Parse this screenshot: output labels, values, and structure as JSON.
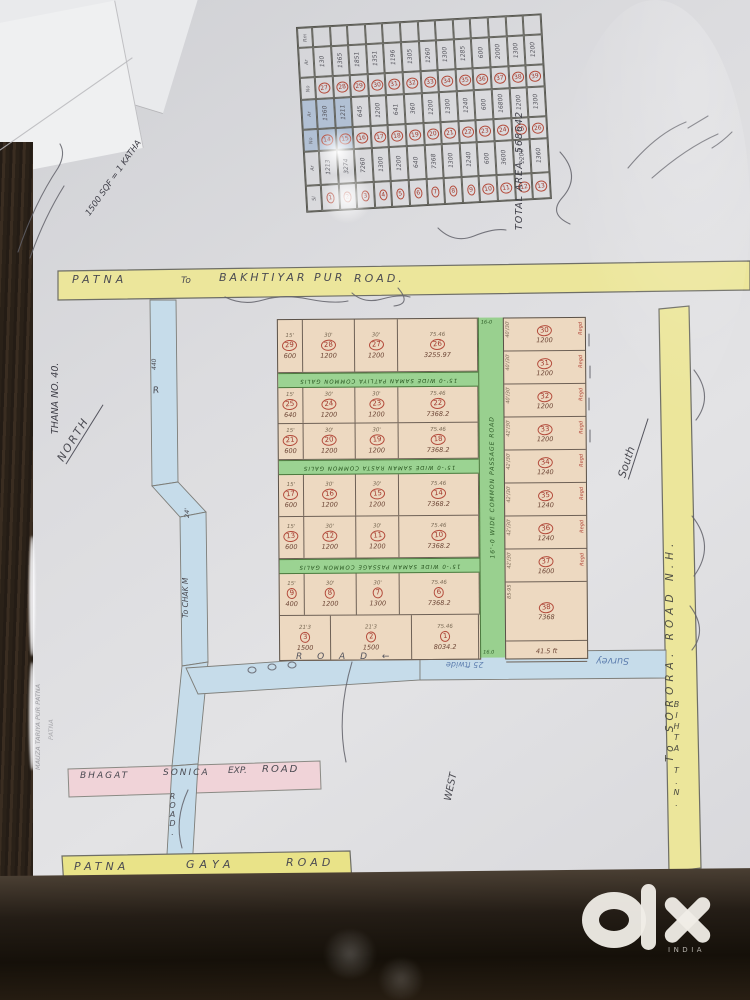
{
  "photo": {
    "watermark": {
      "brand": "olx",
      "region": "INDIA"
    }
  },
  "roads": {
    "top": {
      "words": [
        "PATNA",
        "To",
        "BAKHTIYAR PUR",
        "ROAD."
      ]
    },
    "right": {
      "label_full": "To SORORA. ROAD  N.H.",
      "bottom": "BIHTA T.N."
    },
    "bottom": {
      "words": [
        "PATNA",
        "GAYA",
        "ROAD"
      ]
    },
    "pink": {
      "words": [
        "BHAGAT",
        "SONICA",
        "EXP.",
        "ROAD"
      ]
    },
    "left": {
      "top": "440",
      "r": "R",
      "mid": "To CHAK M",
      "width": "24'",
      "bottom": "ROAD."
    },
    "main": {
      "label": "R O A D ←",
      "width_note": "25 ftwide",
      "survey": "Survey"
    },
    "green_vertical": {
      "label": "16'-0 WIDE COMMON PASSAGE ROAD",
      "top_mark": "16-0",
      "bottom_mark": "16.0"
    },
    "green_strips": [
      "15'-0 WIDE SAMAN PATLIYA COMMON GALIS",
      "15'-0 WIDE SAMAN RASTA COMMON GALIS",
      "15'-0 WIDE SAMAN PASSAGE COMMON GALIS"
    ]
  },
  "compass": {
    "north": "NORTH",
    "south": "South",
    "west": "WEST"
  },
  "notes": {
    "thana": "THANA NO. 40.",
    "katha": "1500 SQF = 1 KATHA",
    "total_area": "TOTAL AREA. 568642",
    "margin1": "MAUZA TARIYA PUR PATNA",
    "margin2": "PATNA"
  },
  "summary_table": {
    "header_col": [
      "Rm",
      "Ar",
      "No",
      "Ar",
      "No",
      "Ar",
      "Sl"
    ],
    "row_top": [
      "",
      "",
      "",
      "",
      "",
      "",
      "",
      "",
      "",
      "",
      "",
      "",
      ""
    ],
    "areas_3": [
      "130",
      "1365",
      "1851",
      "1351",
      "1196",
      "1305",
      "1260",
      "1300",
      "1285",
      "600",
      "2000",
      "1300",
      "1200"
    ],
    "plots_27_39": [
      "27",
      "28",
      "29",
      "30",
      "31",
      "32",
      "33",
      "34",
      "35",
      "36",
      "37",
      "38",
      "39"
    ],
    "areas_2": [
      "1360",
      "1211",
      "645",
      "1200",
      "641",
      "360",
      "1200",
      "1300",
      "1240",
      "600",
      "16800",
      "1200",
      "1300"
    ],
    "plots_14_26": [
      "14",
      "15",
      "16",
      "17",
      "18",
      "19",
      "20",
      "21",
      "22",
      "23",
      "24",
      "25",
      "26"
    ],
    "areas_1": [
      "1213",
      "3274",
      "7260",
      "1300",
      "1200",
      "640",
      "7368",
      "1300",
      "1240",
      "600",
      "3600",
      "1200",
      "1360"
    ],
    "plots_1_13": [
      "1",
      "2",
      "3",
      "4",
      "5",
      "6",
      "7",
      "8",
      "9",
      "10",
      "11",
      "12",
      "13"
    ]
  },
  "plot_grid": {
    "reg_mark": "Regd",
    "left_rows": [
      {
        "cells": [
          {
            "n": "29",
            "a": "600",
            "d": "15'"
          },
          {
            "n": "28",
            "a": "1200",
            "d": "30'"
          },
          {
            "n": "27",
            "a": "1200",
            "d": "30'"
          },
          {
            "n": "26",
            "a": "3255.97",
            "d": "75.46"
          }
        ]
      },
      {
        "cells": [
          {
            "n": "25",
            "a": "640",
            "d": "15'"
          },
          {
            "n": "24",
            "a": "1200",
            "d": "30'"
          },
          {
            "n": "23",
            "a": "1200",
            "d": "30'"
          },
          {
            "n": "22",
            "a": "7368.2",
            "d": "75.46"
          }
        ]
      },
      {
        "cells": [
          {
            "n": "21",
            "a": "600",
            "d": "15'"
          },
          {
            "n": "20",
            "a": "1200",
            "d": "30'"
          },
          {
            "n": "19",
            "a": "1200",
            "d": "30'"
          },
          {
            "n": "18",
            "a": "7368.2",
            "d": "75.46"
          }
        ]
      },
      {
        "cells": [
          {
            "n": "17",
            "a": "600",
            "d": "15'"
          },
          {
            "n": "16",
            "a": "1200",
            "d": "30'"
          },
          {
            "n": "15",
            "a": "1200",
            "d": "30'"
          },
          {
            "n": "14",
            "a": "7368.2",
            "d": "75.46"
          }
        ]
      },
      {
        "cells": [
          {
            "n": "13",
            "a": "600",
            "d": "15'"
          },
          {
            "n": "12",
            "a": "1200",
            "d": "30'"
          },
          {
            "n": "11",
            "a": "1200",
            "d": "30'"
          },
          {
            "n": "10",
            "a": "7368.2",
            "d": "75.46"
          }
        ]
      },
      {
        "cells": [
          {
            "n": "9",
            "a": "400",
            "d": "15'"
          },
          {
            "n": "8",
            "a": "1200",
            "d": "30'"
          },
          {
            "n": "7",
            "a": "1300",
            "d": "30'"
          },
          {
            "n": "6",
            "a": "7368.2",
            "d": "75.46"
          }
        ]
      }
    ],
    "bottom_row": [
      {
        "n": "3",
        "a": "1500",
        "d": "21'3"
      },
      {
        "n": "2",
        "a": "1500",
        "d": "21'3"
      },
      {
        "n": "1",
        "a": "8034.2",
        "d": "75.46"
      }
    ],
    "right_col": [
      {
        "n": "30",
        "a": "1200",
        "d": "40'/30'"
      },
      {
        "n": "31",
        "a": "1200",
        "d": "40'/30'"
      },
      {
        "n": "32",
        "a": "1200",
        "d": "40'/30'"
      },
      {
        "n": "33",
        "a": "1200",
        "d": "42'/30'"
      },
      {
        "n": "34",
        "a": "1240",
        "d": "42'/30'"
      },
      {
        "n": "35",
        "a": "1240",
        "d": "42'/30'"
      },
      {
        "n": "36",
        "a": "1240",
        "d": "42'/30'"
      },
      {
        "n": "37",
        "a": "1600",
        "d": "42'/30'"
      },
      {
        "n": "38",
        "a": "7368",
        "d": "85-95"
      },
      {
        "n": "",
        "a": "41.5 ft",
        "d": ""
      }
    ]
  }
}
